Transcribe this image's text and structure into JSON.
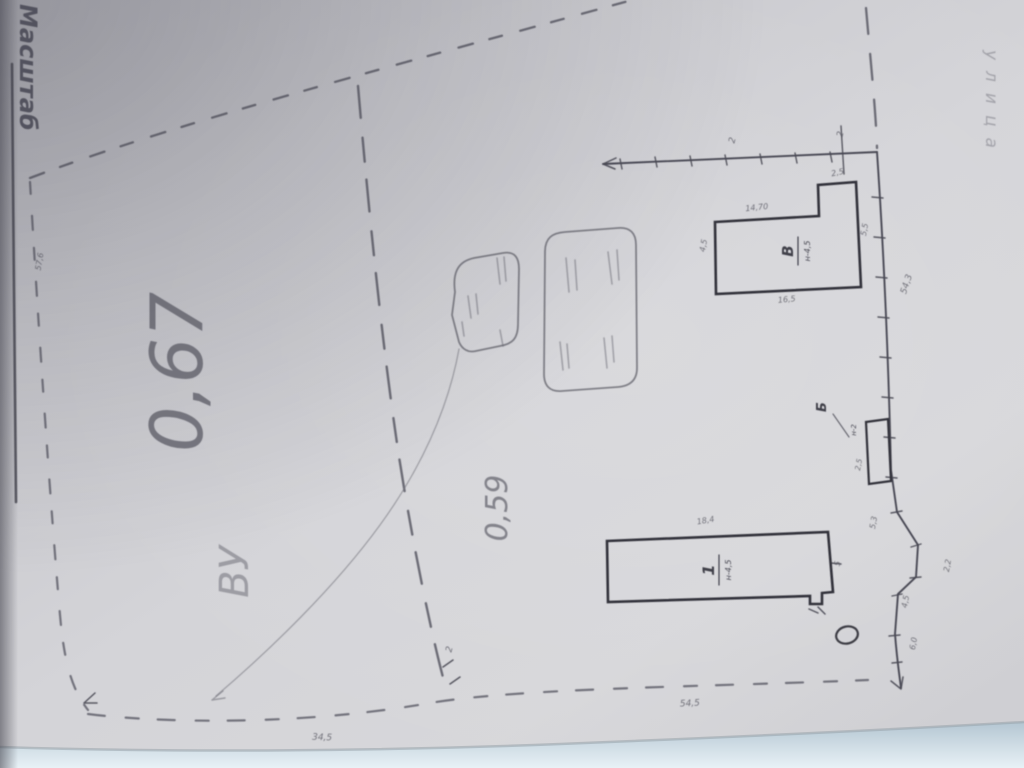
{
  "colors": {
    "paper": "#d3d3d7",
    "table_background": "#dce8f0",
    "pencil": "#5b5b65",
    "dark_ink": "#33333b"
  },
  "labels": {
    "scale": "Масштаб",
    "street": "улица",
    "area_left": "0,67",
    "note_left": "ВУ",
    "area_right": "0,59"
  },
  "buildings": [
    {
      "label": "1",
      "sub": "н-4,5"
    },
    {
      "label": "В",
      "sub": "н-4,5"
    },
    {
      "label": "Б",
      "sub": "н-2"
    }
  ],
  "dims": {
    "left_side": "57,6",
    "top_a": "2",
    "top_b": "2",
    "notch": "2,5",
    "bldB_top": "14,70",
    "bldB_left": "4,5",
    "bldB_right": "5,5",
    "bldB_bottom": "16,5",
    "right_side": "54,3",
    "bld_b_side": "2,5",
    "bld1_top": "18,4",
    "bld1_right": "5",
    "zig_a": "5,3",
    "zig_b": "2,2",
    "zig_c": "4,5",
    "zig_d": "6,0",
    "junction": "2",
    "bottom_a": "34,5",
    "bottom_b": "54,5"
  }
}
